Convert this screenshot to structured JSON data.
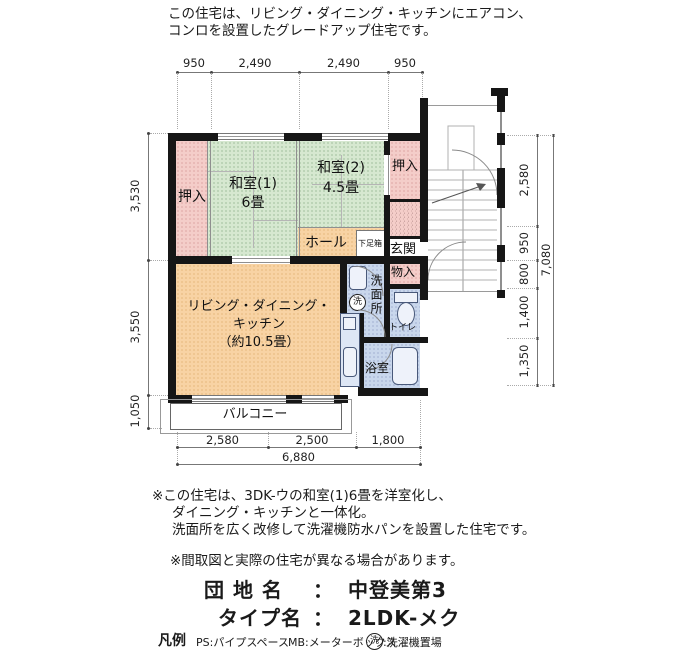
{
  "header": {
    "line1": "この住宅は、リビング・ダイニング・キッチンにエアコン、",
    "line2": "コンロを設置したグレードアップ住宅です。"
  },
  "rooms": {
    "oshiire_left": "押入",
    "washitsu1_name": "和室(1)",
    "washitsu1_size": "6畳",
    "washitsu2_name": "和室(2)",
    "washitsu2_size": "4.5畳",
    "oshiire_right": "押入",
    "hall": "ホール",
    "shoebox": "下足箱",
    "genkan": "玄関",
    "monoire": "物入",
    "senmenjo": "洗面所",
    "laundry_symbol": "洗",
    "toilet": "トイレ",
    "bath": "浴室",
    "ldk_line1": "リビング・ダイニング・",
    "ldk_line2": "キッチン",
    "ldk_line3": "（約10.5畳）",
    "balcony": "バルコニー"
  },
  "dims": {
    "top": [
      "950",
      "2,490",
      "2,490",
      "950"
    ],
    "left": [
      "3,530",
      "3,550",
      "1,050"
    ],
    "right": [
      "2,580",
      "950",
      "800",
      "1,400",
      "1,350"
    ],
    "right_total": "7,080",
    "bottom": [
      "2,580",
      "2,500",
      "1,800"
    ],
    "bottom_total": "6,880"
  },
  "notes": {
    "remodel_line1": "※この住宅は、3DK-ウの和室(1)6畳を洋室化し、",
    "remodel_line2": "ダイニング・キッチンと一体化。",
    "remodel_line3": "洗面所を広く改修して洗濯機防水パンを設置した住宅です。",
    "disclaimer": "※間取図と実際の住宅が異なる場合があります。"
  },
  "footer": {
    "estate_label": "団 地 名",
    "separator": "：",
    "estate_value": "中登美第3",
    "type_label": "タイプ名",
    "type_value": "2LDK-メク"
  },
  "legend": {
    "title": "凡例",
    "ps": "PS:パイプスペース",
    "mb": "MB:メーターボックス",
    "laundry_key": "洗",
    "laundry_value": ":洗濯機置場"
  },
  "colors": {
    "tatami_green": "#d6e8d0",
    "closet_pink": "#f4cdc9",
    "hall_orange": "#f8d3a4",
    "wet_blue": "#c9d7ec",
    "wall_black": "#161616"
  }
}
